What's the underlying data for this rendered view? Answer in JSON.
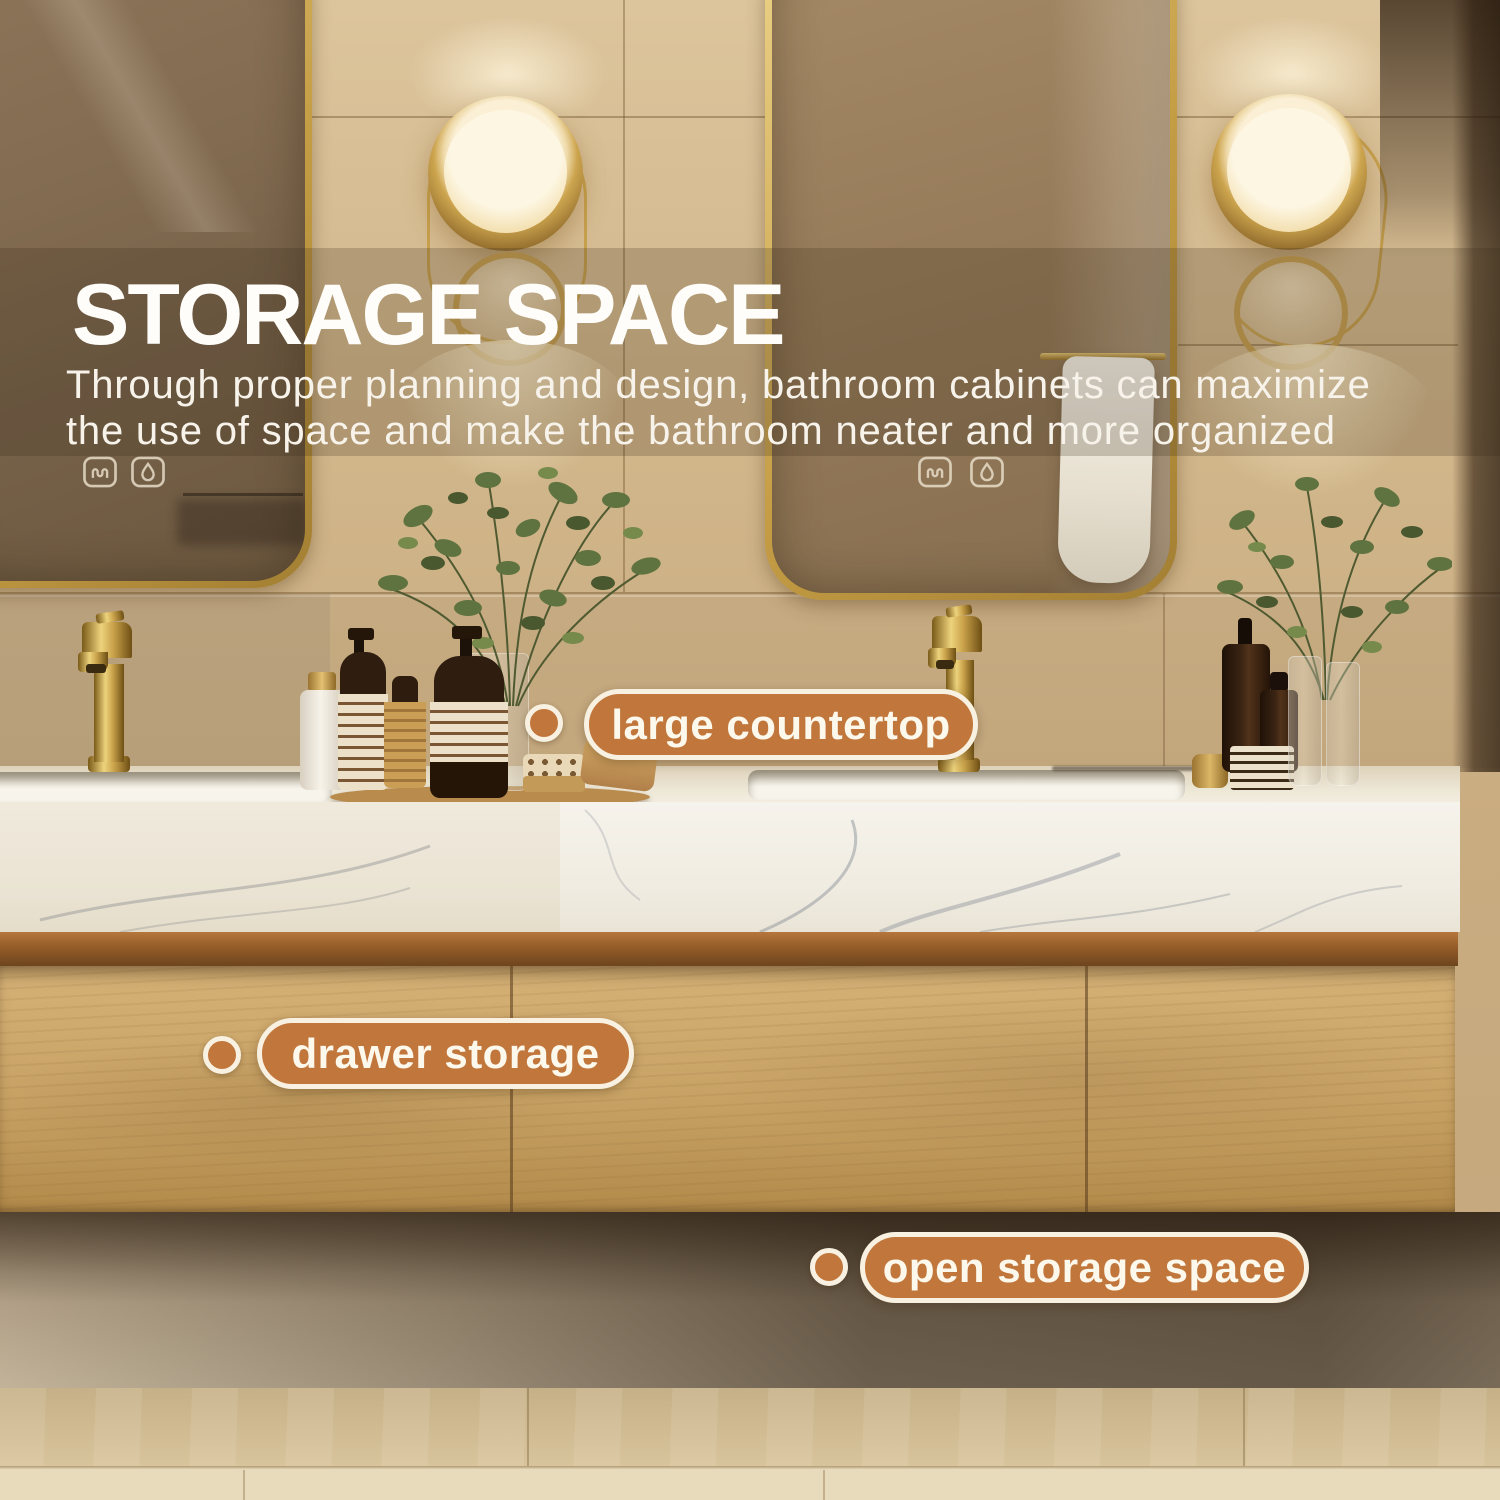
{
  "overlay": {
    "title": "STORAGE SPACE",
    "subtitle_lines": [
      "Through proper planning and design, bathroom cabinets can maximize",
      "the use of space and make the bathroom neater and more organized"
    ]
  },
  "annotations": [
    {
      "id": "large-countertop",
      "text": "large countertop"
    },
    {
      "id": "drawer-storage",
      "text": "drawer storage"
    },
    {
      "id": "open-storage-space",
      "text": "open storage space"
    }
  ],
  "icons": {
    "defogger-icon": "wavy-lines-in-rounded-square",
    "droplet-icon": "water-drop-in-rounded-square"
  },
  "colors": {
    "accent_orange": "#c1763c",
    "pill_border": "#f8f1e1",
    "pill_text": "#fdf8ec",
    "title_white": "#fefdf9",
    "gold_frame": "#d8b960",
    "wall_beige": "#cdb289",
    "wood_cabinet": "#c7a164",
    "marble_white": "#f4f1ea",
    "floor_beige": "#d8c49c",
    "shadow_brown": "#3f2e1c"
  }
}
